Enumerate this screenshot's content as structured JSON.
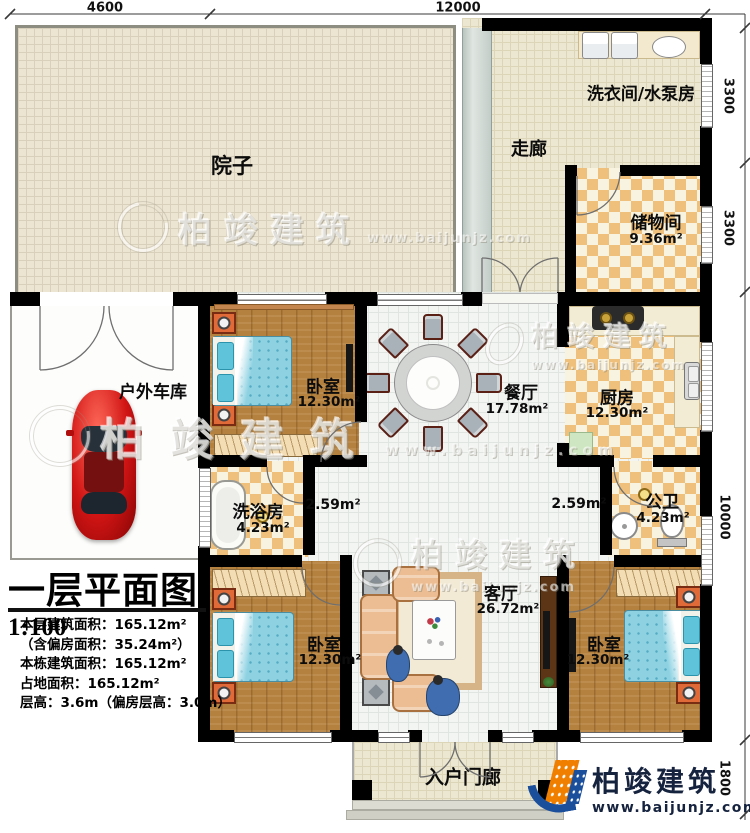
{
  "dimensions": {
    "top": [
      "4600",
      "12000"
    ],
    "right": [
      "3300",
      "3300",
      "10000",
      "1800"
    ]
  },
  "rooms": {
    "courtyard": {
      "label": "院子"
    },
    "corridor": {
      "label": "走廊"
    },
    "laundry": {
      "label": "洗衣间/水泵房"
    },
    "storage": {
      "label": "储物间",
      "area": "9.36m²"
    },
    "garage": {
      "label": "户外车库"
    },
    "bedroom_top": {
      "label": "卧室",
      "area": "12.30m²"
    },
    "dining": {
      "label": "餐厅",
      "area": "17.78m²"
    },
    "kitchen": {
      "label": "厨房",
      "area": "12.30m²"
    },
    "bath": {
      "label": "洗浴房",
      "area": "4.23m²"
    },
    "hall_left": {
      "area": "2.59m²"
    },
    "hall_right": {
      "area": "2.59m²"
    },
    "wc": {
      "label": "公卫",
      "area": "4.23m²"
    },
    "living": {
      "label": "客厅",
      "area": "26.72m²"
    },
    "bedroom_left": {
      "label": "卧室",
      "area": "12.30m²"
    },
    "bedroom_right": {
      "label": "卧室",
      "area": "12.30m²"
    },
    "porch": {
      "label": "入户门廊"
    }
  },
  "title_block": {
    "title": "一层平面图",
    "scale": "1:100",
    "stats": [
      "本层建筑面积：165.12m²",
      "（含偏房面积：35.24m²）",
      "本栋建筑面积：165.12m²",
      "占地面积：165.12m²",
      "层高：3.6m（偏房层高：3.0m）"
    ]
  },
  "branding": {
    "watermark_name": "柏竣建筑",
    "watermark_url": "www.baijunjz.com",
    "logo_name": "柏竣建筑",
    "logo_url": "www.baijunjz.com"
  },
  "colors": {
    "wall": "#000000",
    "checker_tan": "#eec07b",
    "wood": "#b5813f",
    "bed_blue": "#8ed2e2",
    "car_red": "#c40f0f",
    "logo_navy": "#16233f",
    "logo_orange": "#f07f00",
    "logo_blue": "#1b4f9c"
  }
}
